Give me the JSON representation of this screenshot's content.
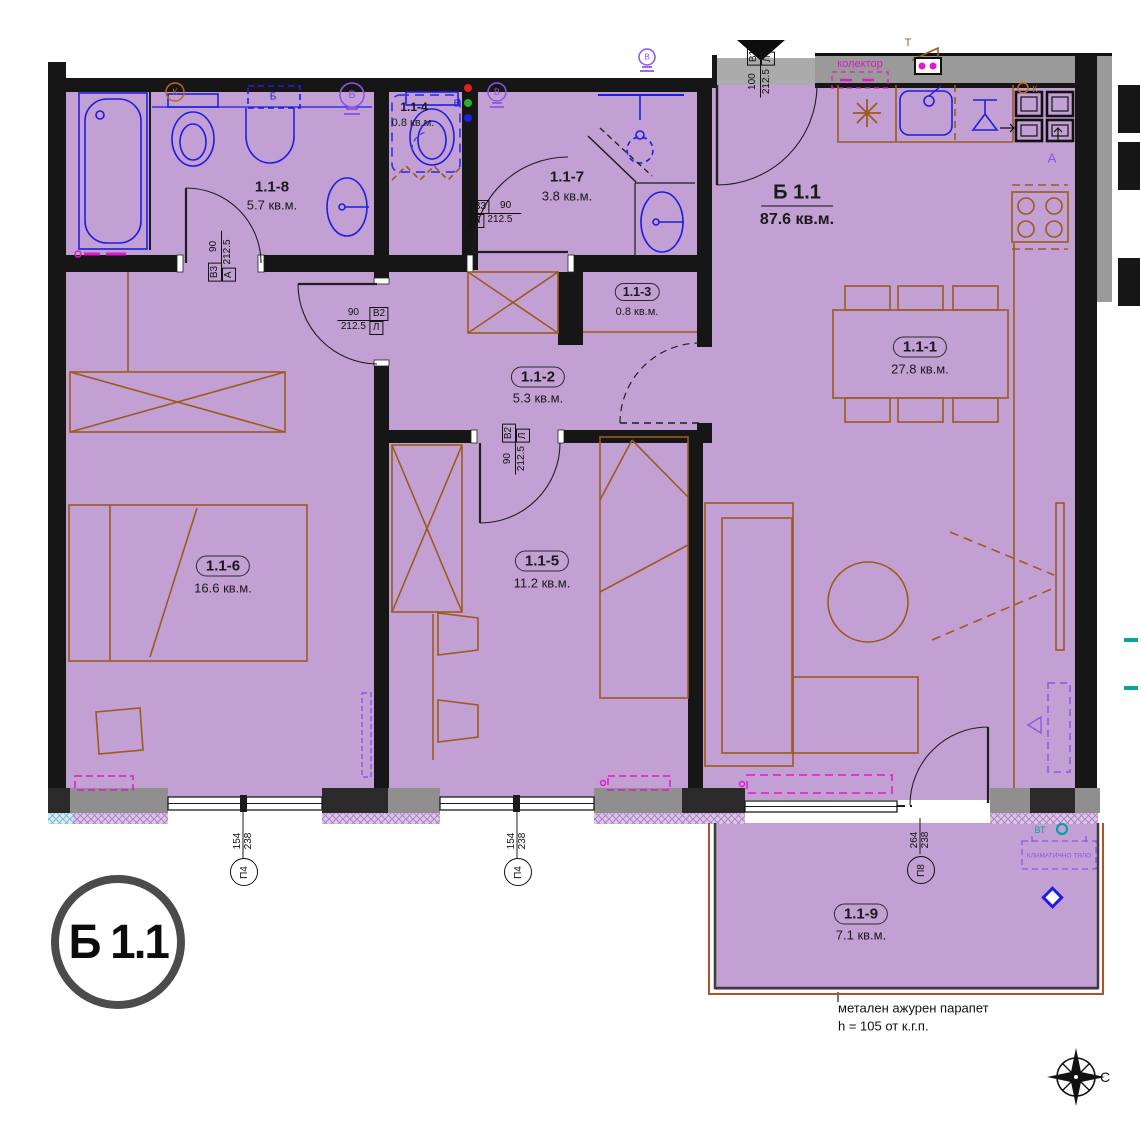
{
  "apartment": {
    "badge": "Б 1.1",
    "title": "Б 1.1",
    "title_area": "87.6 кв.м.",
    "rooms": [
      {
        "id": "1.1-1",
        "area": "27.8 кв.м."
      },
      {
        "id": "1.1-2",
        "area": "5.3 кв.м."
      },
      {
        "id": "1.1-3",
        "area": "0.8 кв.м."
      },
      {
        "id": "1.1-4",
        "area": "0.8 кв.м."
      },
      {
        "id": "1.1-5",
        "area": "11.2 кв.м."
      },
      {
        "id": "1.1-6",
        "area": "16.6 кв.м."
      },
      {
        "id": "1.1-7",
        "area": "3.8 кв.м."
      },
      {
        "id": "1.1-8",
        "area": "5.7 кв.м."
      },
      {
        "id": "1.1-9",
        "area": "7.1 кв.м."
      }
    ],
    "door_marks": [
      {
        "type": "В3",
        "width": "90",
        "height": "212.5",
        "hinge": "А"
      },
      {
        "type": "В3",
        "width": "90",
        "height": "212.5",
        "hinge": "Л"
      },
      {
        "type": "В2",
        "width": "90",
        "height": "212.5",
        "hinge": "Л"
      },
      {
        "type": "В2",
        "width": "90",
        "height": "212.5",
        "hinge": "Л"
      },
      {
        "type": "В1",
        "width": "100",
        "height": "212.5",
        "hinge": "Л"
      }
    ],
    "window_marks": [
      {
        "id": "П4",
        "width": "154",
        "height": "238"
      },
      {
        "id": "П4",
        "width": "154",
        "height": "238"
      },
      {
        "id": "П8",
        "width": "264",
        "height": "238"
      }
    ],
    "labels": {
      "collector": "колектор",
      "t": "Т",
      "k": "К",
      "b": "Б",
      "v": "В",
      "a": "А",
      "vt": "ВТ",
      "ac": "КЛИМАТИЧНО ТЯЛО"
    },
    "railing_note_line1": "метален ажурен парапет",
    "railing_note_line2": "h = 105 от к.г.п.",
    "compass_north": "С",
    "colors": {
      "floor": "#c3a0d3",
      "wall": "#161616",
      "fixtures": "#1e1ee0",
      "furniture": "#9c5a1d",
      "service": "#e318c8",
      "violet": "#8d55e8",
      "teal": "#0aa2a8"
    }
  }
}
